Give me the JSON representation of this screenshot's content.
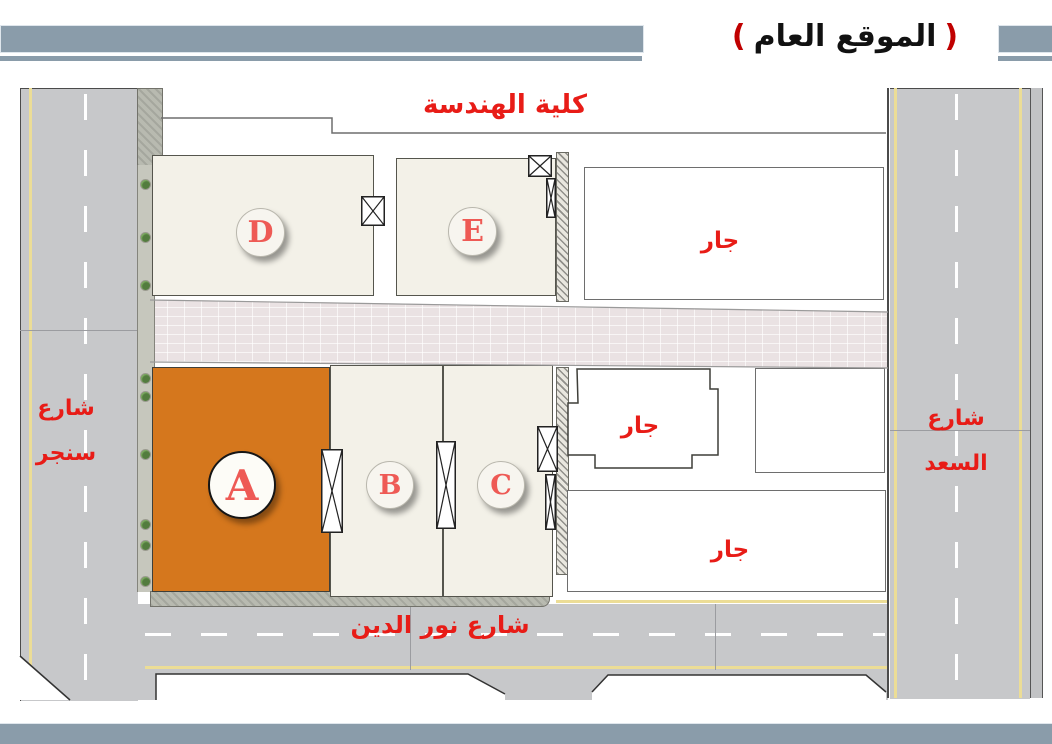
{
  "slide": {
    "title_paren_open": "(",
    "title_text": "الموقع العام",
    "title_paren_close": ")"
  },
  "labels": {
    "faculty": "كلية الهندسة",
    "street_left_line1": "شارع",
    "street_left_line2": "سنجر",
    "street_right_line1": "شارع",
    "street_right_line2": "السعد",
    "street_bottom": "شارع نور الدين",
    "neighbor_top": "جار",
    "neighbor_middle": "جار",
    "neighbor_bottom": "جار"
  },
  "buildings": {
    "a": "A",
    "b": "B",
    "c": "C",
    "d": "D",
    "e": "E"
  },
  "colors": {
    "header_bar": "#8a9caa",
    "building_highlight_orange": "#d5771d",
    "building_neutral_cream": "#f3f1e8",
    "label_red": "#e81c17",
    "circle_letter_red": "#ee5a55",
    "road_gray": "#c7c8ca",
    "paved_strip_pink": "#eae2e3",
    "lane_yellow": "#ecdd96"
  }
}
